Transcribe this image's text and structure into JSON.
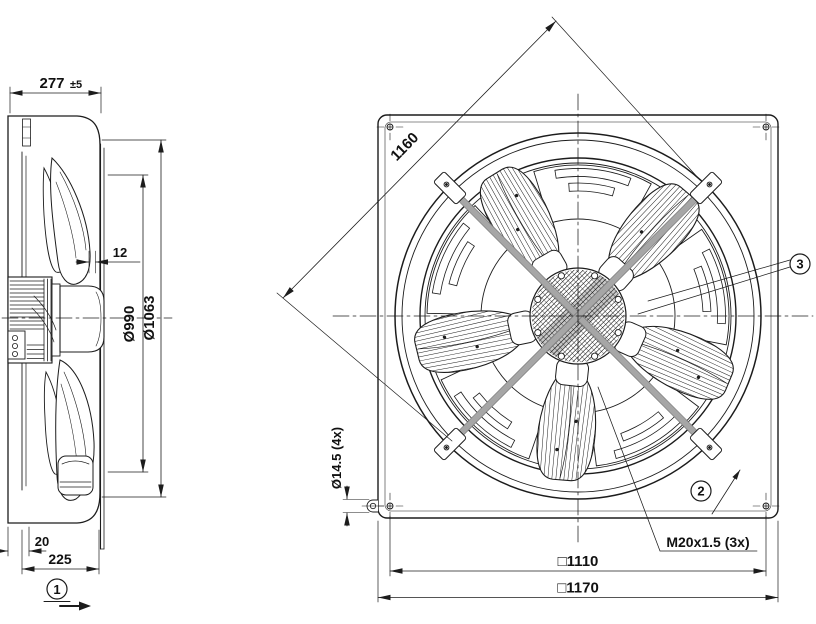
{
  "side_view": {
    "width_value": "277",
    "width_tolerance": "±5",
    "tip_gap": "12",
    "impeller_diameter": "Ø990",
    "ring_diameter": "Ø1063",
    "motor_offset": "20",
    "depth": "225",
    "view_arrow_label": "1"
  },
  "front_view": {
    "diagonal_brace": "1160",
    "mounting_hole": "Ø14.5 (4x)",
    "hole_pitch": "□1110",
    "plate_width": "□1170",
    "cable_gland": "M20x1.5 (3x)",
    "callout_guard_strut": "2",
    "callout_hub": "3"
  },
  "colors": {
    "line": "#1c1c1c",
    "strut_fill": "#a6a6a6",
    "strut_edge": "#757575",
    "background": "#ffffff"
  }
}
